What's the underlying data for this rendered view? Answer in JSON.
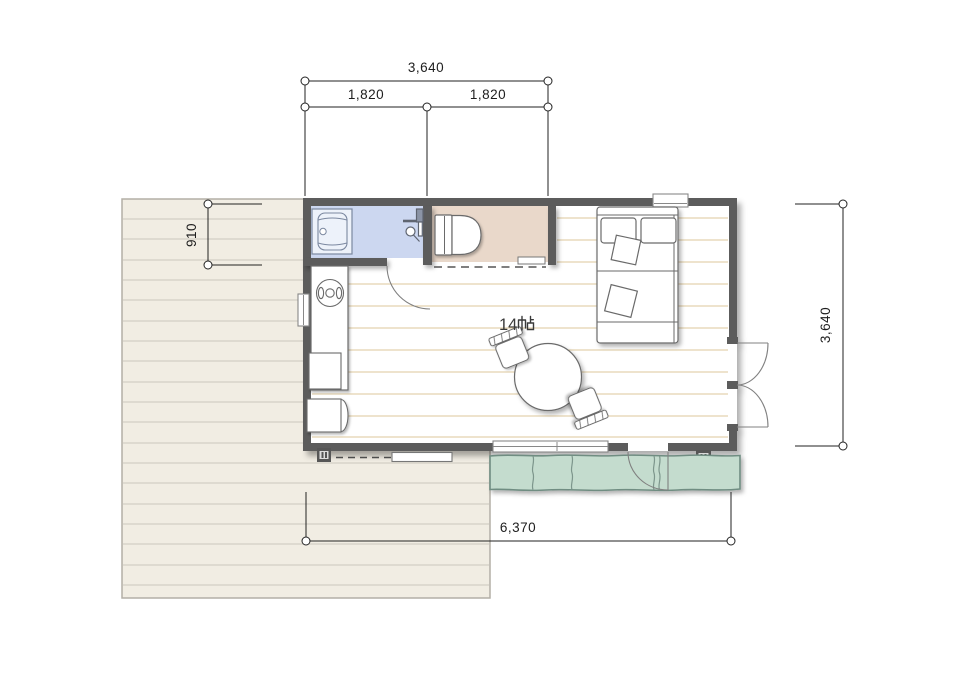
{
  "room": {
    "area_label": "14帖",
    "area_number": "14",
    "area_unit": "帖"
  },
  "dimensions": {
    "top_total": "3,640",
    "top_span_left": "1,820",
    "top_span_right": "1,820",
    "left_depth": "910",
    "right_height": "3,640",
    "bottom_total": "6,370"
  },
  "colors": {
    "wall": "#5b5b5b",
    "bathroom_floor": "#ccd7f0",
    "toilet_floor": "#e9d8ca",
    "engawa_deck": "#c4dcce",
    "engawa_edge": "#6f8d82",
    "wood_deck": "#f1ede3",
    "deck_line": "#cbc7be",
    "deck_edge": "#b3afa6",
    "floor_line": "#dcc79b",
    "furniture_outline": "#6a6a6a",
    "dimension_line": "#222222"
  },
  "fixtures": {
    "bathroom": [
      "vanity-sink",
      "shower-mixer"
    ],
    "toilet_room": [
      "toilet",
      "sliding-door-track"
    ],
    "main_room": [
      "kitchen-counter",
      "round-sink",
      "cabinet",
      "stool",
      "bed",
      "pillows",
      "cushions",
      "dining-table",
      "chairs"
    ],
    "openings": [
      "top-window",
      "left-window",
      "sliding-window",
      "hinged-door",
      "double-door",
      "deck-door"
    ],
    "exterior": [
      "wood-deck",
      "engawa-deck",
      "vent-left",
      "vent-right",
      "step-board"
    ]
  }
}
